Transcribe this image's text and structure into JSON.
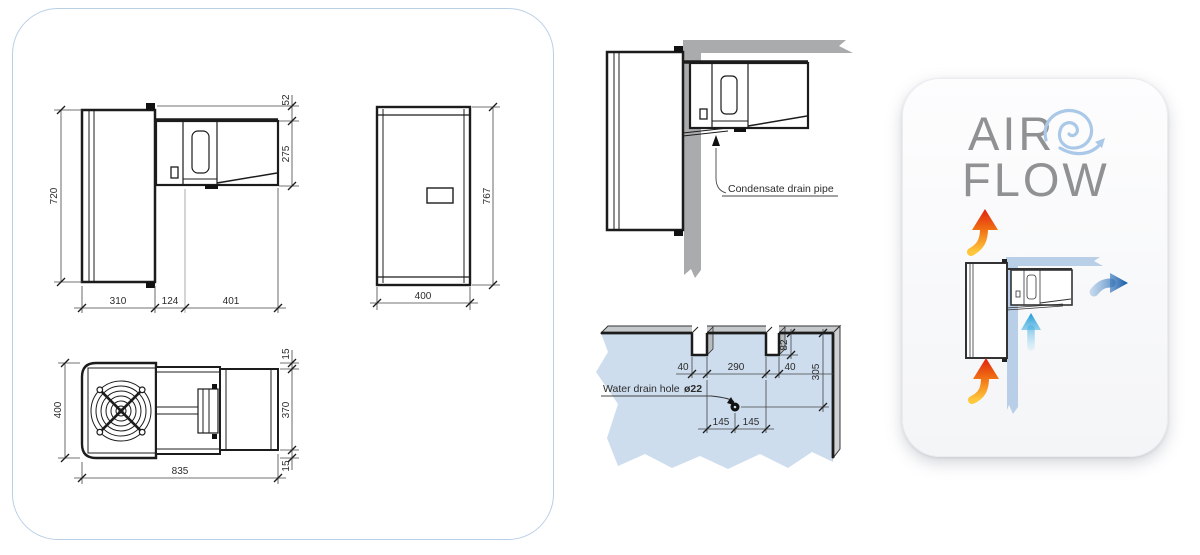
{
  "side_view": {
    "height": "720",
    "gap_top": "52",
    "unit_height": "275",
    "wall_depth": "310",
    "gap_middle": "124",
    "unit_depth": "401"
  },
  "front_view": {
    "width": "400",
    "height": "767"
  },
  "top_view": {
    "depth": "400",
    "margin_top": "15",
    "unit_width": "370",
    "margin_bottom": "15",
    "length": "835"
  },
  "installation": {
    "callout": "Condensate drain pipe"
  },
  "wall_cutout": {
    "callout": "Water drain hole",
    "hole_diameter": "ø22",
    "notch_left_width": "40",
    "notch_span": "290",
    "notch_right_width": "40",
    "notch_depth": "82",
    "hole_offset_top": "305",
    "hole_center_left": "145",
    "hole_center_right": "145"
  },
  "airflow": {
    "title_line_1": "AIR",
    "title_line_2": "FLOW"
  },
  "colors": {
    "panel_border_blue": "#b9cfe6",
    "wall_light_blue": "#cdddee",
    "wall_gray": "#a9abad",
    "hot_air_red": "#e02010",
    "hot_air_yellow": "#ffc83c",
    "cold_air_cyan": "#1e9cd8",
    "outlet_blue": "#1258a8",
    "swirl_blue": "#aac8e7",
    "title_gray": "#8f9193"
  }
}
